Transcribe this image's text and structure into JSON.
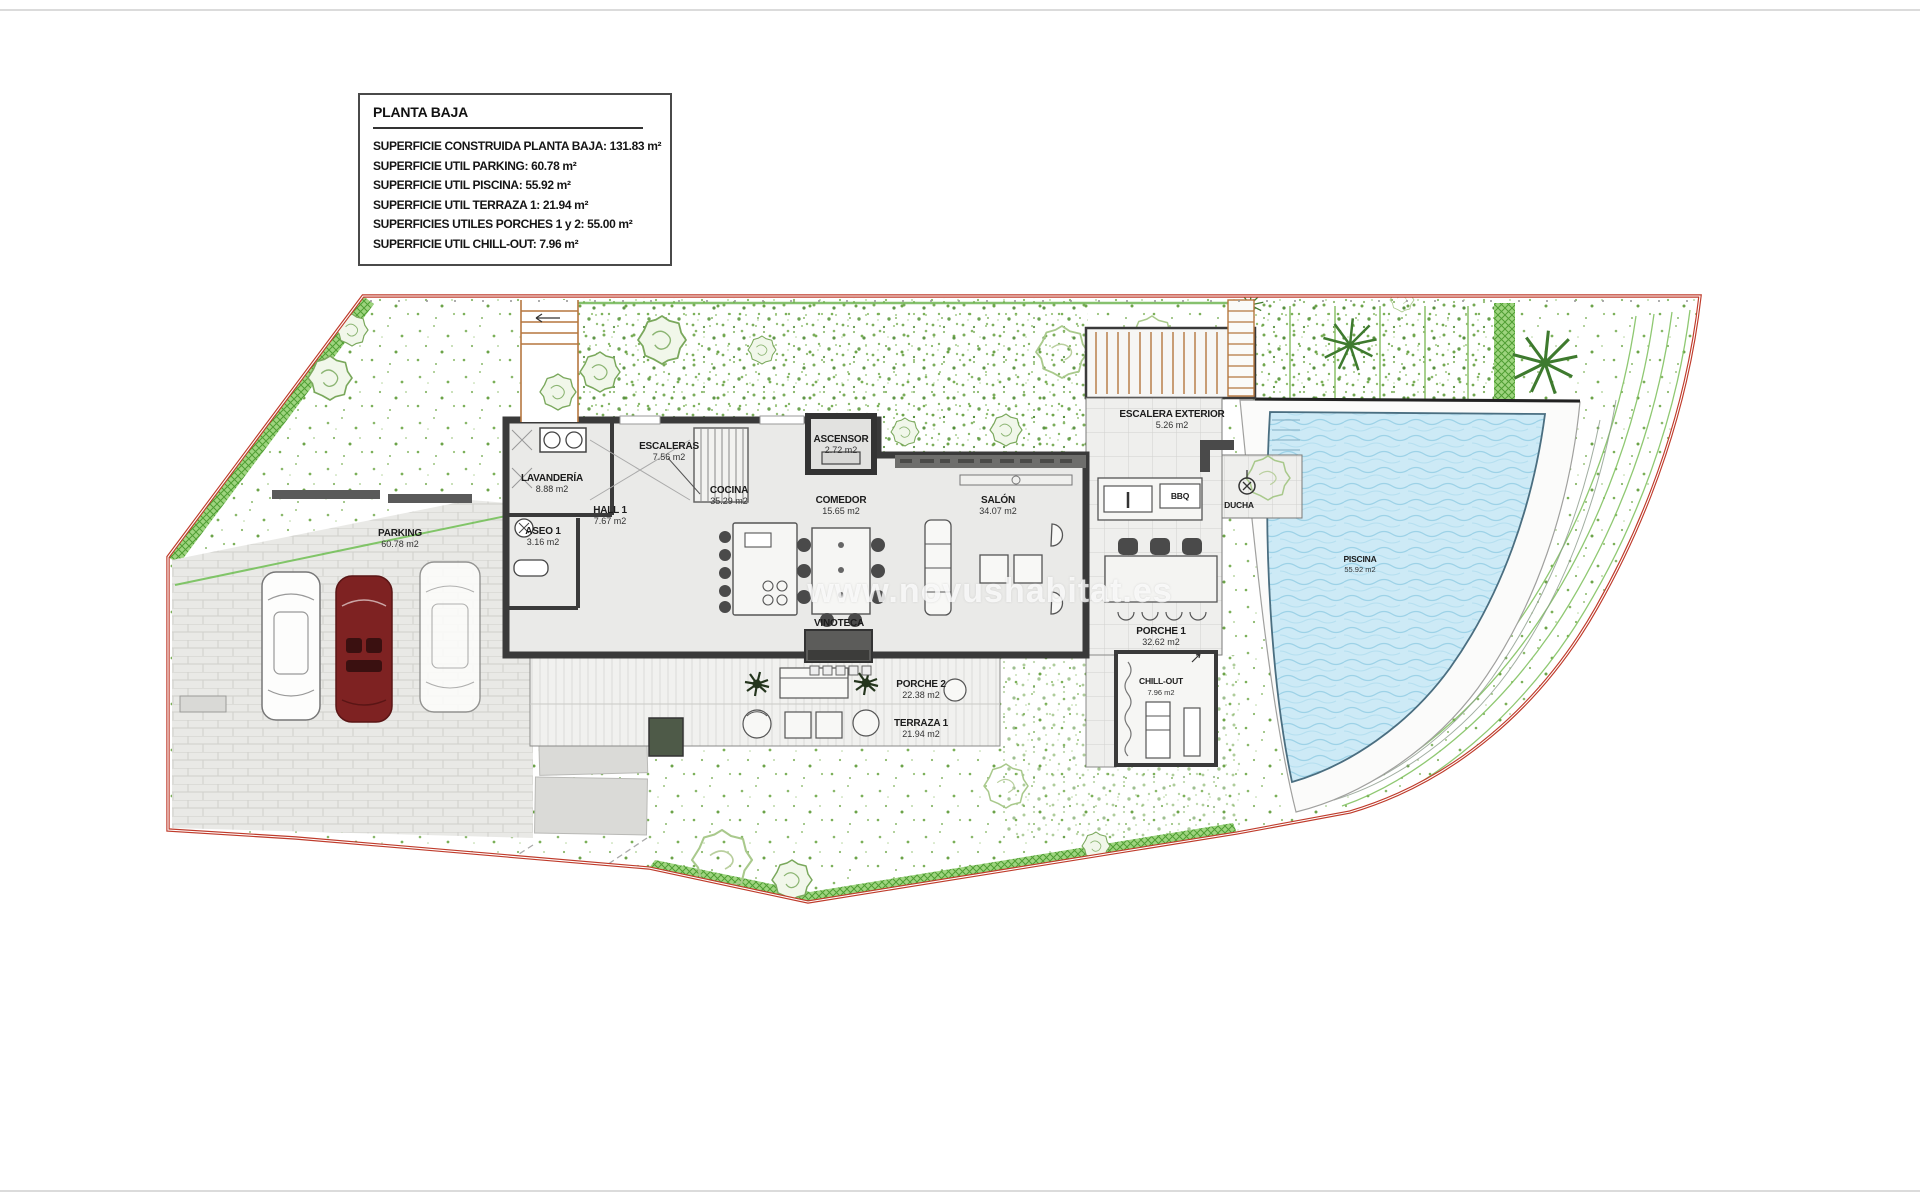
{
  "page": {
    "watermark": "www.novushabitat.es"
  },
  "legend": {
    "title": "PLANTA BAJA",
    "lines": [
      "SUPERFICIE CONSTRUIDA PLANTA BAJA: 131.83 m²",
      "SUPERFICIE UTIL PARKING: 60.78 m²",
      "SUPERFICIE UTIL PISCINA: 55.92 m²",
      "SUPERFICIE UTIL TERRAZA 1: 21.94 m²",
      "SUPERFICIES UTILES PORCHES 1 y 2: 55.00 m²",
      "SUPERFICIE UTIL CHILL-OUT: 7.96 m²"
    ]
  },
  "labels": {
    "escaleras": {
      "name": "ESCALERAS",
      "area": "7.56 m2"
    },
    "lavanderia": {
      "name": "LAVANDERÍA",
      "area": "8.88 m2"
    },
    "aseo1": {
      "name": "ASEO 1",
      "area": "3.16 m2"
    },
    "hall1": {
      "name": "HALL 1",
      "area": "7.67 m2"
    },
    "cocina": {
      "name": "COCINA",
      "area": "35.29 m2"
    },
    "ascensor": {
      "name": "ASCENSOR",
      "area": "2.72 m2"
    },
    "comedor": {
      "name": "COMEDOR",
      "area": "15.65 m2"
    },
    "salon": {
      "name": "SALÓN",
      "area": "34.07 m2"
    },
    "vinoteca": {
      "name": "VINOTECA"
    },
    "parking": {
      "name": "PARKING",
      "area": "60.78 m2"
    },
    "escalera_exterior": {
      "name": "ESCALERA EXTERIOR",
      "area": "5.26 m2"
    },
    "bbq": {
      "name": "BBQ"
    },
    "ducha": {
      "name": "DUCHA"
    },
    "porche1": {
      "name": "PORCHE 1",
      "area": "32.62 m2"
    },
    "porche2": {
      "name": "PORCHE 2",
      "area": "22.38 m2"
    },
    "terraza1": {
      "name": "TERRAZA 1",
      "area": "21.94 m2"
    },
    "chillout": {
      "name": "CHILL-OUT",
      "area": "7.96 m2"
    },
    "piscina": {
      "name": "PISCINA",
      "area": "55.92 m2"
    }
  },
  "colors": {
    "boundary_red": "#bf3b2b",
    "hedge_green": "#6ab74a",
    "pool_blue": "#cdeaf6",
    "wall_gray": "#3a3a3a",
    "stair_orange": "#b5773f",
    "car_maroon": "#7e2222"
  }
}
